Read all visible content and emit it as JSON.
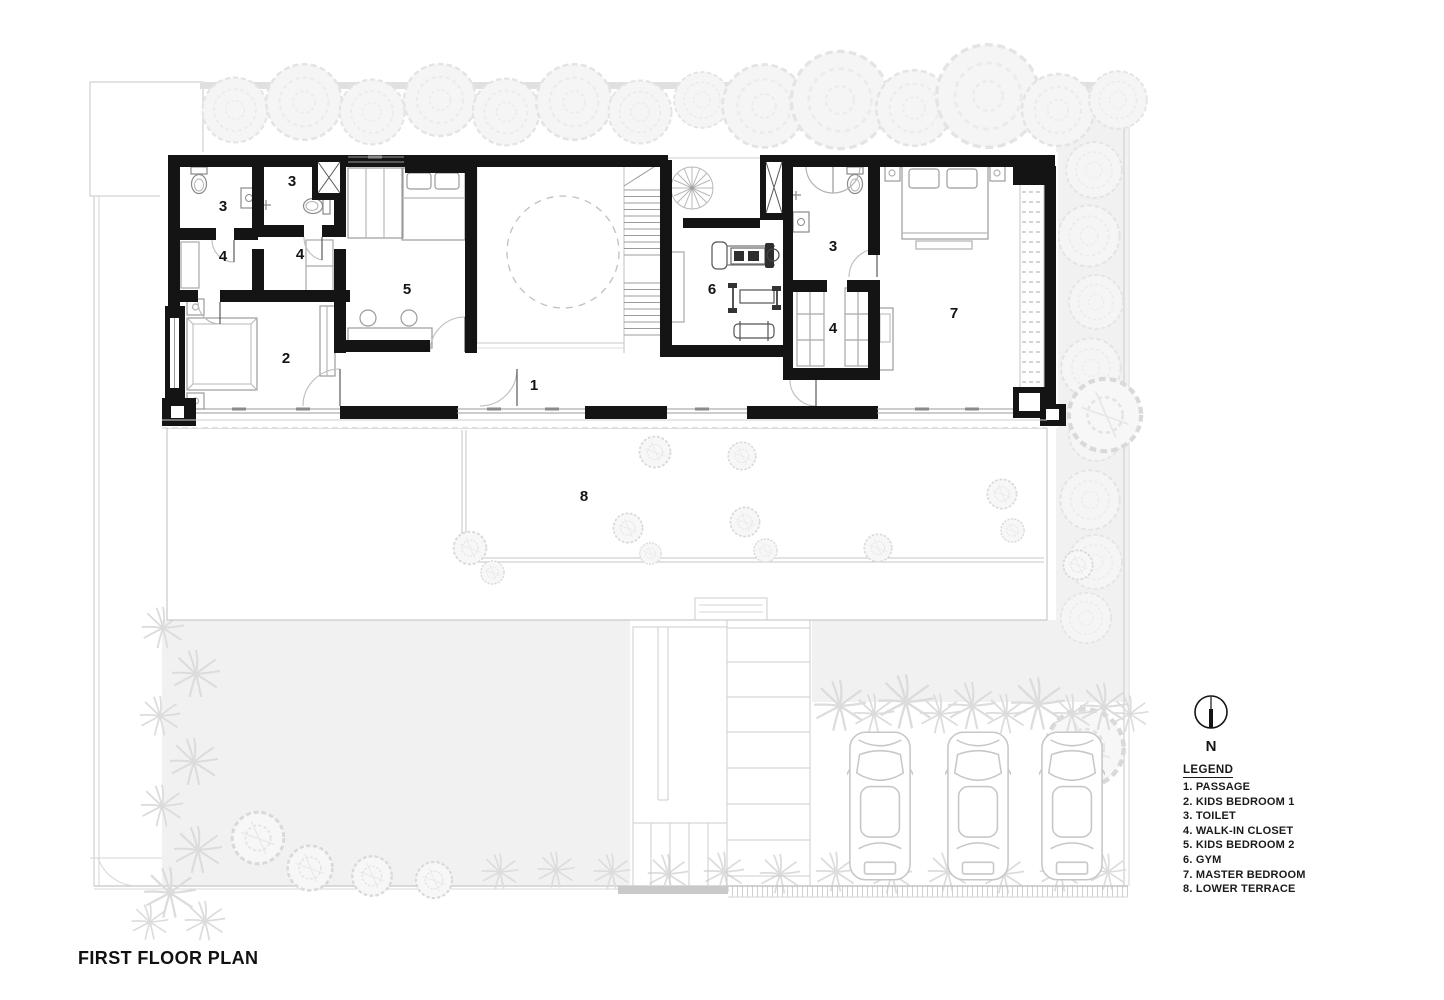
{
  "title": "FIRST FLOOR PLAN",
  "north": {
    "label": "N"
  },
  "legend": {
    "title": "LEGEND",
    "items": [
      "1. PASSAGE",
      "2. KIDS BEDROOM 1",
      "3. TOILET",
      "4. WALK-IN CLOSET",
      "5. KIDS BEDROOM 2",
      "6. GYM",
      "7. MASTER BEDROOM",
      "8. LOWER TERRACE"
    ]
  },
  "room_labels": [
    {
      "room": "toilet-left-1",
      "text": "3"
    },
    {
      "room": "toilet-left-2",
      "text": "3"
    },
    {
      "room": "walk-in-closet-left-1",
      "text": "4"
    },
    {
      "room": "walk-in-closet-left-2",
      "text": "4"
    },
    {
      "room": "kids-bedroom-1",
      "text": "2"
    },
    {
      "room": "kids-bedroom-2",
      "text": "5"
    },
    {
      "room": "passage",
      "text": "1"
    },
    {
      "room": "gym",
      "text": "6"
    },
    {
      "room": "toilet-right",
      "text": "3"
    },
    {
      "room": "walk-in-closet-right",
      "text": "4"
    },
    {
      "room": "master-bedroom",
      "text": "7"
    },
    {
      "room": "lower-terrace",
      "text": "8"
    }
  ]
}
